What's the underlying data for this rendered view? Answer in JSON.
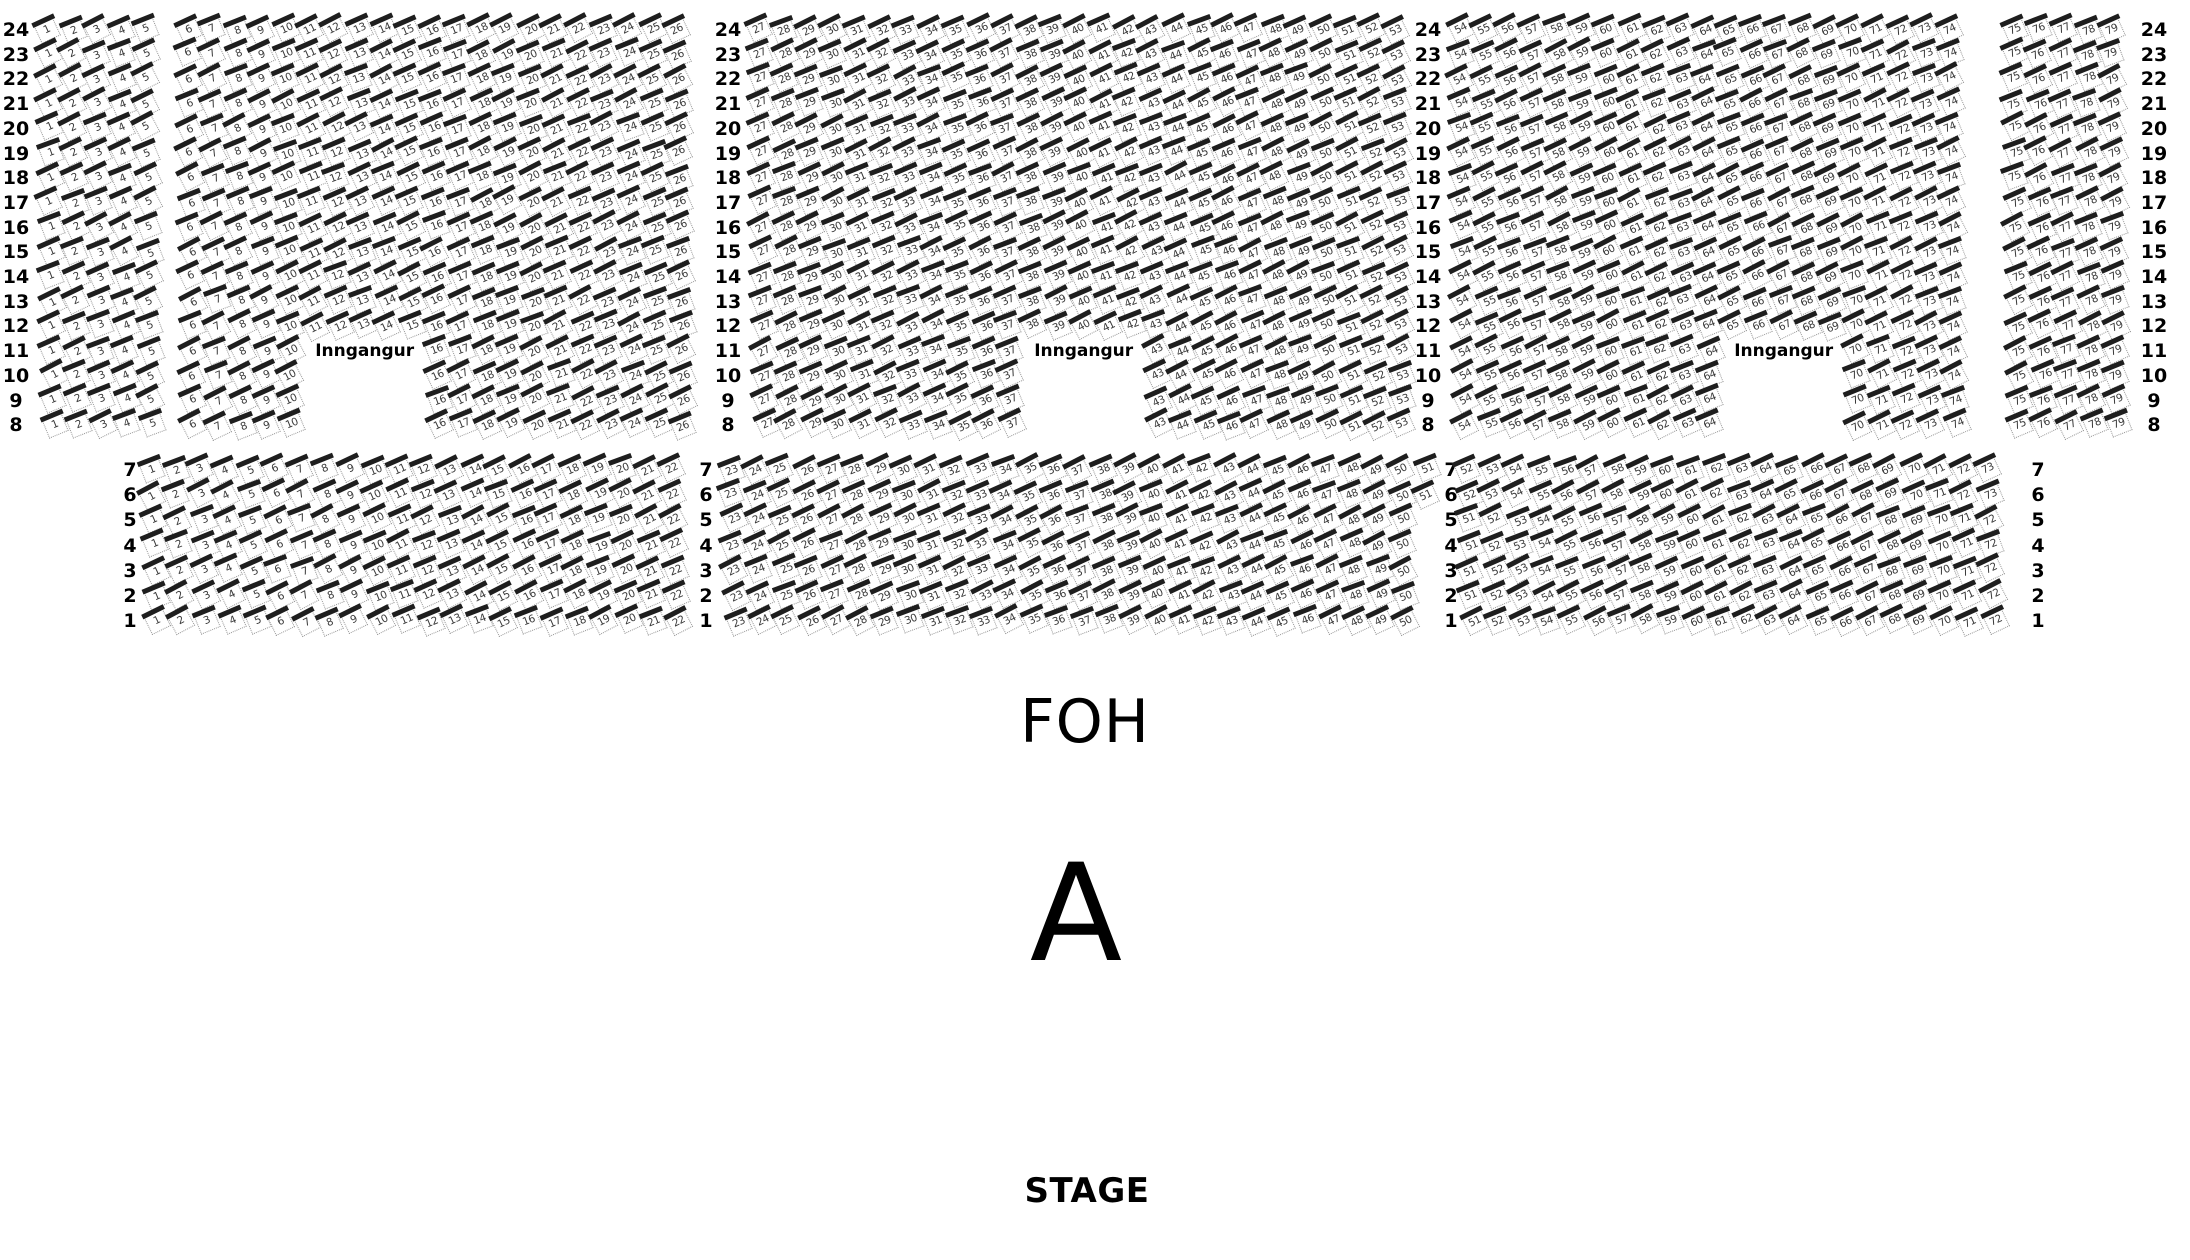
{
  "labels": {
    "foh": "FOH",
    "section": "A",
    "stage": "STAGE",
    "entrance": "Inngangur"
  },
  "colors": {
    "text": "#000000",
    "seat_back": "#1e1e1e",
    "seat_border": "#979797",
    "seat_number": "#3a3a3a",
    "background": "#ffffff"
  },
  "seat_map": {
    "top": {
      "rows": {
        "from": 24,
        "to": 8
      },
      "y_start": 30,
      "row_pitch": 24.7,
      "pitch": 24.5,
      "skew": 0.4,
      "seat_blocks": [
        [
          1,
          5,
          48
        ],
        [
          6,
          26,
          188
        ],
        [
          27,
          53,
          760
        ],
        [
          54,
          74,
          1460
        ],
        [
          75,
          79,
          2014
        ]
      ],
      "row_label_columns_x": [
        16,
        728,
        1428,
        2154
      ],
      "entrance_rows": {
        "from": 11,
        "to": 8
      },
      "entrance_label_row": 11,
      "entrances": [
        {
          "seats": [
            11,
            15
          ]
        },
        {
          "seats": [
            38,
            42
          ]
        },
        {
          "seats": [
            65,
            69
          ]
        }
      ]
    },
    "bottom": {
      "rows": {
        "from": 7,
        "to": 1
      },
      "y_start": 470,
      "row_pitch": 25.2,
      "pitch": 24.8,
      "skew": 0.9,
      "row_label_columns_x": [
        130,
        706,
        1451,
        2038
      ],
      "variants": [
        {
          "rows": {
            "from": 7,
            "to": 6
          },
          "seat_blocks": [
            [
              1,
              22,
              152
            ],
            [
              23,
              51,
              732
            ],
            [
              52,
              73,
              1468
            ]
          ]
        },
        {
          "rows": {
            "from": 5,
            "to": 1
          },
          "seat_blocks": [
            [
              1,
              22,
              152
            ],
            [
              23,
              50,
              732
            ],
            [
              51,
              72,
              1468
            ]
          ]
        }
      ]
    }
  }
}
